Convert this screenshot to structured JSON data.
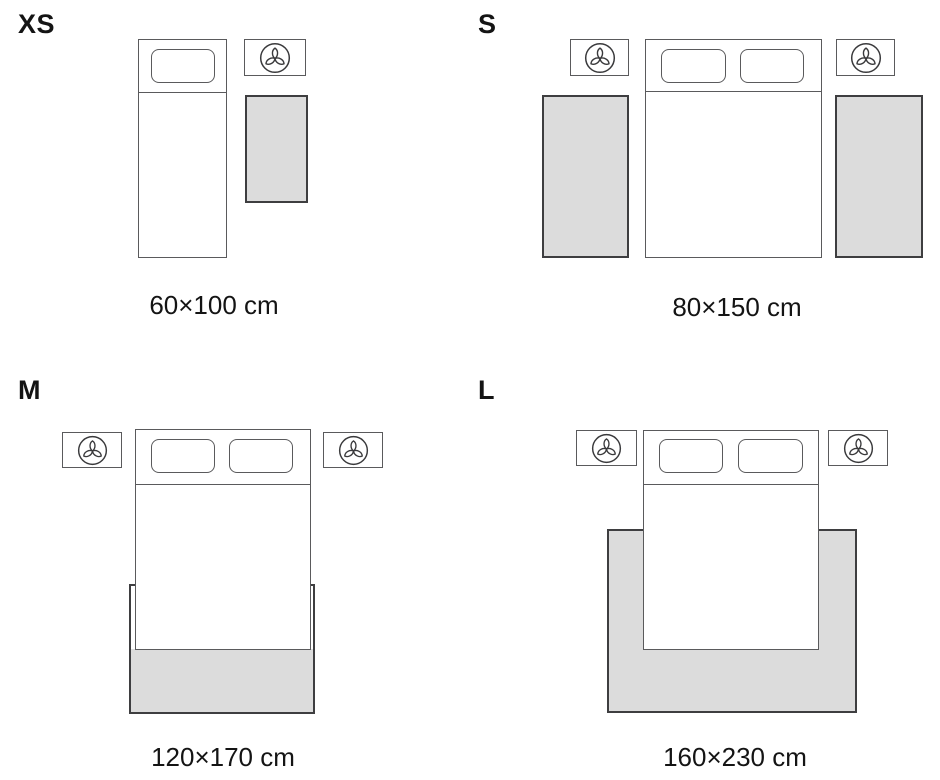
{
  "colors": {
    "background": "#ffffff",
    "outline": "#5a5a5c",
    "rug_fill": "#dcdcdc",
    "rug_border": "#3e3e40",
    "text": "#141414",
    "icon": "#3a3a3c"
  },
  "variants": [
    {
      "label": "XS",
      "dimensions": "60×100 cm"
    },
    {
      "label": "S",
      "dimensions": "80×150 cm"
    },
    {
      "label": "M",
      "dimensions": "120×170 cm"
    },
    {
      "label": "L",
      "dimensions": "160×230 cm"
    }
  ],
  "icons": {
    "nightstand": "plant-icon"
  }
}
